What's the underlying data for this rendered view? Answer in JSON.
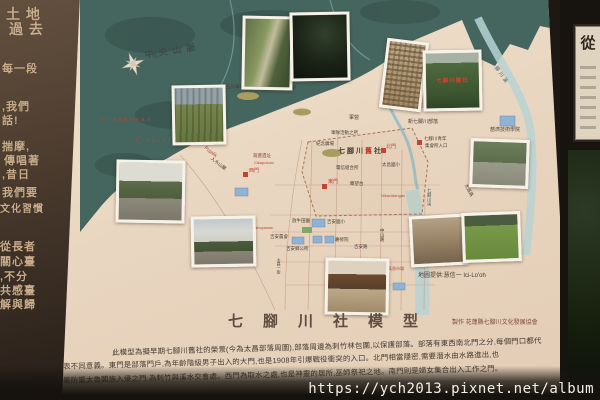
{
  "left_panel": {
    "fragments": [
      {
        "t": "土 地",
        "x": 6,
        "y": 4,
        "s": 14
      },
      {
        "t": "過 去",
        "x": 9,
        "y": 19,
        "s": 14
      },
      {
        "t": "每一段",
        "x": 2,
        "y": 60,
        "s": 11
      },
      {
        "t": ",我們",
        "x": 2,
        "y": 98,
        "s": 11
      },
      {
        "t": "話!",
        "x": 2,
        "y": 112,
        "s": 11
      },
      {
        "t": "揣摩,",
        "x": 2,
        "y": 138,
        "s": 11
      },
      {
        "t": "傳唱著",
        "x": 4,
        "y": 152,
        "s": 11
      },
      {
        "t": ",昔日",
        "x": 2,
        "y": 166,
        "s": 11
      },
      {
        "t": "我們要",
        "x": 2,
        "y": 184,
        "s": 11
      },
      {
        "t": "文化習慣",
        "x": 0,
        "y": 200,
        "s": 10
      },
      {
        "t": "從長者",
        "x": 0,
        "y": 238,
        "s": 11
      },
      {
        "t": "關心臺",
        "x": 0,
        "y": 253,
        "s": 11
      },
      {
        "t": ",不分",
        "x": 0,
        "y": 268,
        "s": 11
      },
      {
        "t": "共感臺",
        "x": 0,
        "y": 282,
        "s": 11
      },
      {
        "t": "解與歸",
        "x": 0,
        "y": 296,
        "s": 11
      }
    ]
  },
  "board": {
    "title": "七腳川社模型",
    "credit": "製作 花蓮縣七腳川文化發展協會",
    "map_source": "地圖提供:慧信一 Ici-Lo'oh",
    "description_lines": [
      {
        "t": "此模型為擬早期七腳川舊社的榮景(今為太昌部落周圍),部落周邊為刺竹林包圍,以保護部落。部落有東西南北門之分,每個門口都代",
        "x": 112,
        "y": 347
      },
      {
        "t": "表不同意義。東門是部落門戶,為年齡階級男子出入的大門,也是1908年引爆戰役衝突的入口。北門相當隱密,需要潛水由水路進出,也",
        "x": 63,
        "y": 361
      },
      {
        "t": "是防禦太魯閣族入侵之門,為刺竹與溪水交會處。西門為取水之處,也是神靈的居所,巫師祭祀之地。南門則是婦女集合出入工作之門。",
        "x": 63,
        "y": 375
      }
    ]
  },
  "map": {
    "old_settlement": {
      "pre": "七腳川",
      "highlight": "舊",
      "post": "社"
    },
    "region_labels": [
      {
        "t": "中央山脈",
        "x": 64,
        "y": 50,
        "s": 9,
        "c": "#3c4b4b",
        "ls": 5,
        "rot": -9,
        "b": 1
      },
      {
        "t": "北",
        "x": 72,
        "y": 53,
        "s": 6,
        "c": "#3c4b4b"
      },
      {
        "t": "Cipaponan",
        "x": 22,
        "y": 118,
        "s": 5,
        "c": "#b5493c",
        "ls": 3
      },
      {
        "t": "Cikarufan",
        "x": 56,
        "y": 139,
        "s": 5,
        "c": "#b5493c",
        "ls": 3
      },
      {
        "t": "五分車站",
        "x": 146,
        "y": 84,
        "s": 4.5
      },
      {
        "t": "山神祠海岸五分車",
        "x": 180,
        "y": 85,
        "s": 4.5
      },
      {
        "t": "Pujalik",
        "x": 126,
        "y": 146,
        "s": 5,
        "c": "#b5493c",
        "rot": 38
      },
      {
        "t": "入水山麓",
        "x": 133,
        "y": 156,
        "s": 4.5,
        "rot": 38
      },
      {
        "t": "葫蘆遺址",
        "x": 173,
        "y": 153,
        "s": 4.5,
        "c": "#8a4a3a"
      },
      {
        "t": "Cikapuican",
        "x": 174,
        "y": 161,
        "s": 4,
        "c": "#b5493c"
      },
      {
        "t": "紀念廣場",
        "x": 236,
        "y": 141,
        "s": 4.5
      },
      {
        "t": "軍營",
        "x": 269,
        "y": 116,
        "s": 5
      },
      {
        "t": "軍隊活動之所",
        "x": 251,
        "y": 130,
        "s": 4.5
      },
      {
        "t": "電信組合所",
        "x": 256,
        "y": 165,
        "s": 4.5
      },
      {
        "t": "太昌國小",
        "x": 302,
        "y": 162,
        "s": 4.5
      },
      {
        "t": "北門",
        "x": 306,
        "y": 145,
        "s": 5,
        "c": "#c24435"
      },
      {
        "t": "西門",
        "x": 169,
        "y": 169,
        "s": 5,
        "c": "#c24435"
      },
      {
        "t": "東門",
        "x": 248,
        "y": 180,
        "s": 5,
        "c": "#c24435"
      },
      {
        "t": "瞭望台",
        "x": 270,
        "y": 181,
        "s": 4.5
      },
      {
        "t": "放牛田園",
        "x": 212,
        "y": 218,
        "s": 4.5
      },
      {
        "t": "Likabuyawan",
        "x": 170,
        "y": 226,
        "s": 4,
        "c": "#b5493c"
      },
      {
        "t": "Nikacidangan",
        "x": 301,
        "y": 194,
        "s": 4,
        "c": "#b5493c"
      },
      {
        "t": "新七腳川部落",
        "x": 328,
        "y": 120,
        "s": 5
      },
      {
        "t": "七腳川青年",
        "x": 344,
        "y": 136,
        "s": 4.5
      },
      {
        "t": "集會所入口",
        "x": 345,
        "y": 143,
        "s": 4.5
      },
      {
        "t": "慈濟技術學院",
        "x": 410,
        "y": 128,
        "s": 5
      },
      {
        "t": "七腳川溪",
        "x": 413,
        "y": 60,
        "s": 5,
        "c": "#46626c",
        "rot": 55,
        "ls": 2
      },
      {
        "t": "七腳川溪",
        "x": 347,
        "y": 188,
        "s": 4.5,
        "c": "#46626c",
        "vert": 1
      },
      {
        "t": "太昌路",
        "x": 388,
        "y": 183,
        "s": 4.5,
        "rot": 62
      },
      {
        "t": "吉安國小",
        "x": 247,
        "y": 219,
        "s": 4.5
      },
      {
        "t": "慶修院",
        "x": 255,
        "y": 237,
        "s": 4.5
      },
      {
        "t": "吉安農會",
        "x": 190,
        "y": 234,
        "s": 4.5
      },
      {
        "t": "吉安鄉公所",
        "x": 206,
        "y": 246,
        "s": 4.5
      },
      {
        "t": "吉安路",
        "x": 274,
        "y": 244,
        "s": 4.5
      },
      {
        "t": "中山路",
        "x": 300,
        "y": 228,
        "s": 4.5,
        "vert": 1
      },
      {
        "t": "黃昏市場",
        "x": 308,
        "y": 267,
        "s": 4,
        "c": "#b5493c"
      },
      {
        "t": "太昌一街",
        "x": 196,
        "y": 258,
        "s": 4,
        "vert": 1
      }
    ],
    "photos": [
      {
        "kind": "cliff",
        "x": 162,
        "y": 16,
        "w": 45,
        "h": 68,
        "rot": 1
      },
      {
        "kind": "forest",
        "x": 210,
        "y": 12,
        "w": 54,
        "h": 63,
        "rot": -1
      },
      {
        "kind": "aerial",
        "x": 303,
        "y": 40,
        "w": 36,
        "h": 64,
        "rot": 7
      },
      {
        "kind": "grove",
        "x": 343,
        "y": 50,
        "w": 53,
        "h": 55,
        "rot": -1,
        "caption": "七腳川舊社"
      },
      {
        "kind": "fields",
        "x": 92,
        "y": 85,
        "w": 48,
        "h": 54,
        "rot": -1
      },
      {
        "kind": "village",
        "x": 36,
        "y": 160,
        "w": 63,
        "h": 57,
        "rot": 1
      },
      {
        "kind": "street",
        "x": 111,
        "y": 216,
        "w": 59,
        "h": 45,
        "rot": -1
      },
      {
        "kind": "shrine",
        "x": 245,
        "y": 258,
        "w": 58,
        "h": 51,
        "rot": 1
      },
      {
        "kind": "sepia",
        "x": 330,
        "y": 215,
        "w": 51,
        "h": 45,
        "rot": -3
      },
      {
        "kind": "park",
        "x": 390,
        "y": 139,
        "w": 53,
        "h": 43,
        "rot": 2
      },
      {
        "kind": "grass",
        "x": 382,
        "y": 212,
        "w": 53,
        "h": 44,
        "rot": -2
      }
    ]
  },
  "right_panel": {
    "plaque_text": "從"
  },
  "watermark": "https://ych2013.pixnet.net/album",
  "colors": {
    "accent_red": "#c24435",
    "water": "#b7d2d4",
    "mountain_teal": "#45655f",
    "building_blue": "#8fb3d6"
  }
}
